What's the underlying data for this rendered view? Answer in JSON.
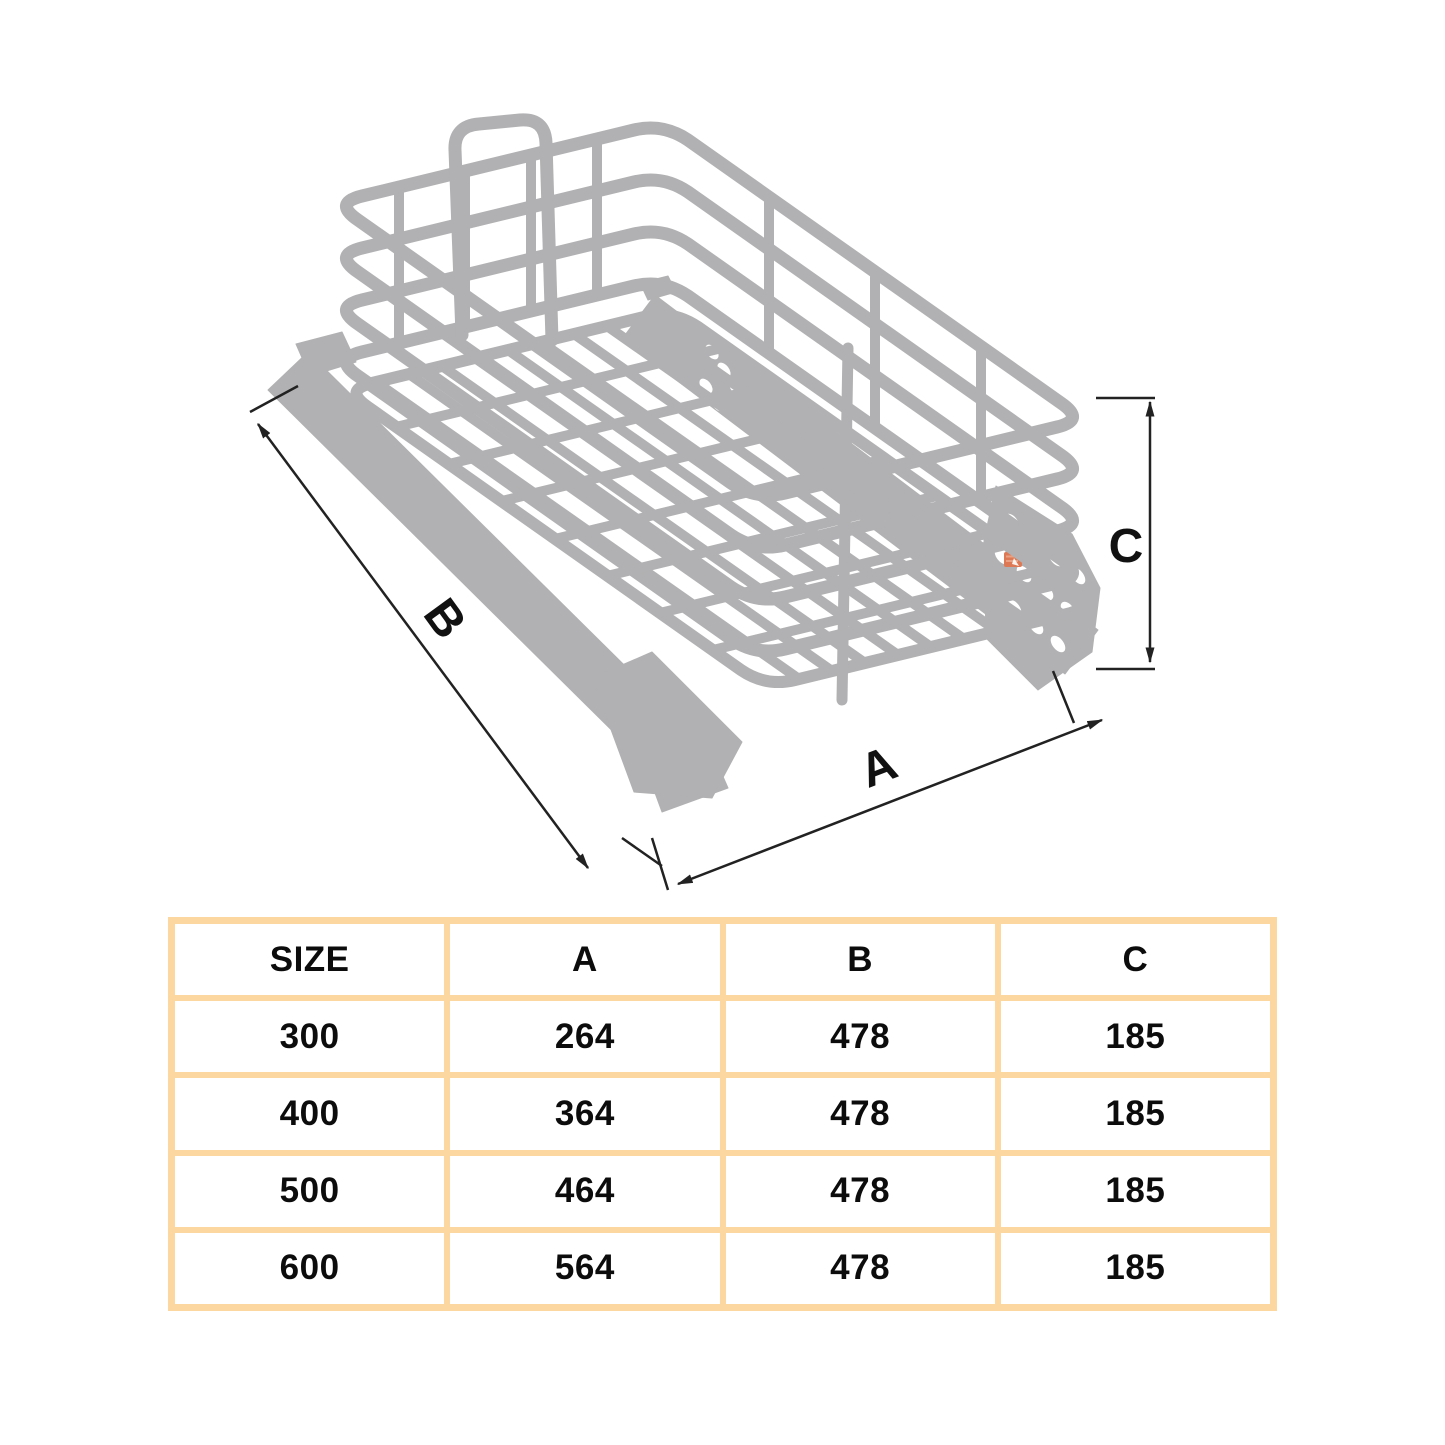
{
  "diagram": {
    "labels": {
      "width": "A",
      "depth": "B",
      "height": "C"
    }
  },
  "table": {
    "headers": [
      "SIZE",
      "A",
      "B",
      "C"
    ],
    "rows": [
      [
        "300",
        "264",
        "478",
        "185"
      ],
      [
        "400",
        "364",
        "478",
        "185"
      ],
      [
        "500",
        "464",
        "478",
        "185"
      ],
      [
        "600",
        "564",
        "478",
        "185"
      ]
    ]
  },
  "colors": {
    "table_border": "#FCD8A0",
    "wire_gray": "#b1b1b3",
    "dimension_line": "#222222",
    "logo_salmon": "#dd7a55"
  }
}
